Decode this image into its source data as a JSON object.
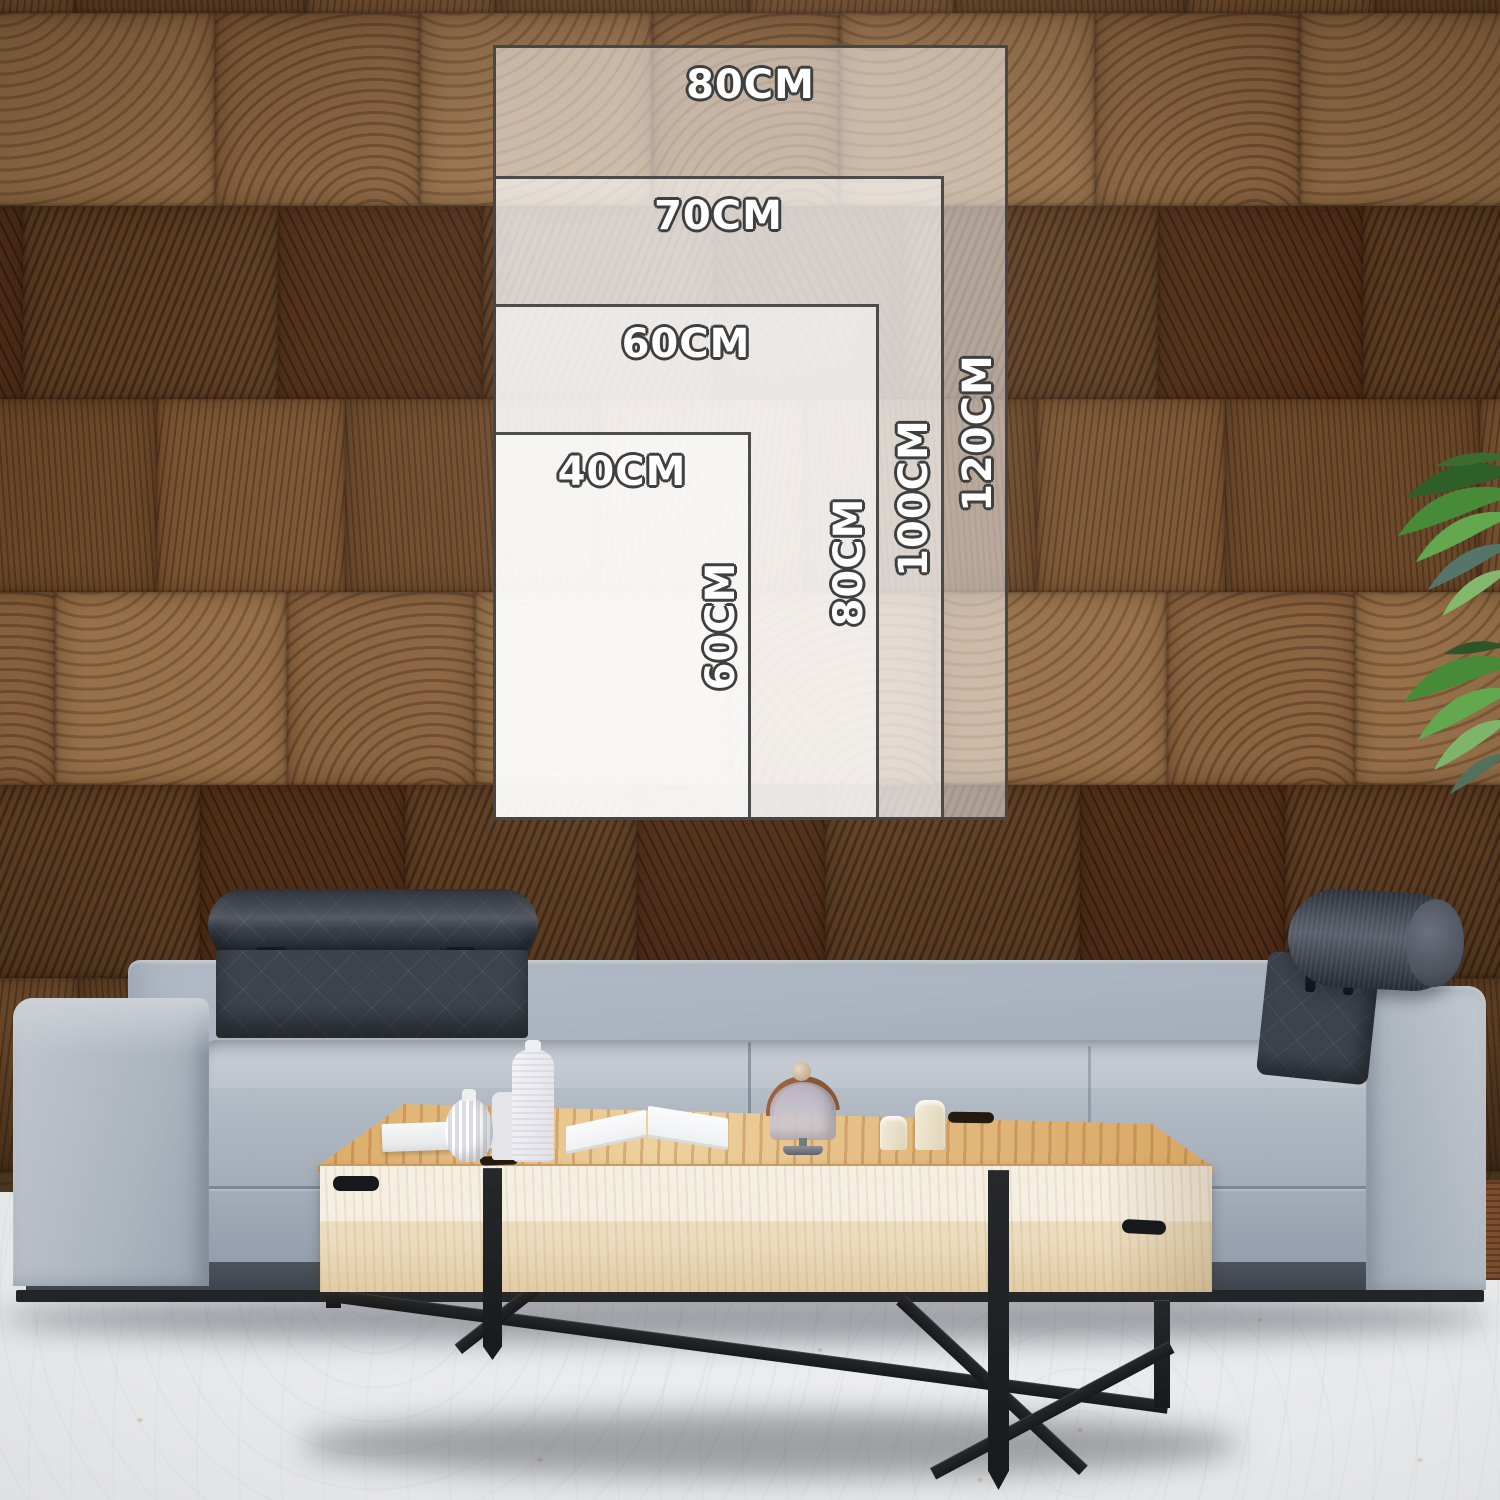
{
  "size_guide": {
    "sizes": [
      {
        "width_cm": 80,
        "height_cm": 120,
        "width_label": "80CM",
        "height_label": "120CM"
      },
      {
        "width_cm": 70,
        "height_cm": 100,
        "width_label": "70CM",
        "height_label": "100CM"
      },
      {
        "width_cm": 60,
        "height_cm": 80,
        "width_label": "60CM",
        "height_label": "80CM"
      },
      {
        "width_cm": 40,
        "height_cm": 60,
        "width_label": "40CM",
        "height_label": "60CM"
      }
    ],
    "overlay": {
      "fill_color": "#ffffff",
      "fill_opacity_per_layer": 0.5,
      "border_color": "#3e3e3e",
      "label_color": "#ffffff",
      "label_outline_color": "#3f3f3f"
    }
  },
  "scene": {
    "wall_wood_color": "#6f4a2c",
    "sofa_fabric_color": "#a9b2bd",
    "headrest_fabric_color": "#3d434d",
    "table_wood_color": "#e8cf9f",
    "table_legs_color": "#1a1c1f",
    "floor_color": "#e9eaec",
    "plant_leaf_color": "#4a8b3e"
  }
}
